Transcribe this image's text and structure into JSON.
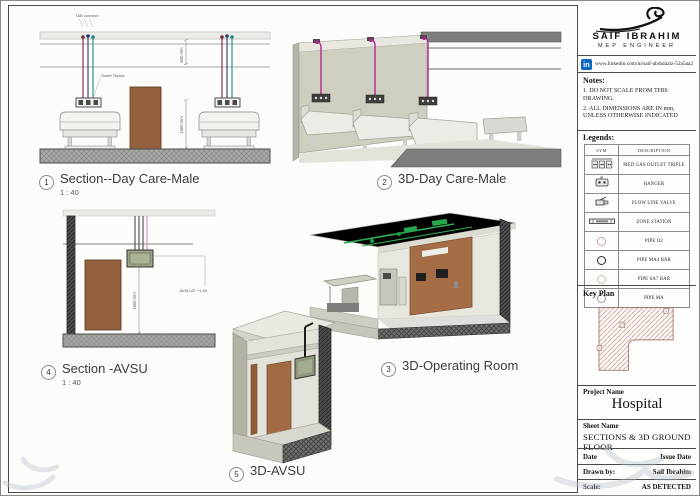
{
  "views": [
    {
      "num": "1",
      "title": "Section--Day Care-Male",
      "scale": "1 : 40"
    },
    {
      "num": "2",
      "title": "3D-Day Care-Male",
      "scale": ""
    },
    {
      "num": "3",
      "title": "3D-Operating Room",
      "scale": ""
    },
    {
      "num": "4",
      "title": "Section -AVSU",
      "scale": "1 : 40"
    },
    {
      "num": "5",
      "title": "3D-AVSU",
      "scale": ""
    }
  ],
  "annotations": {
    "tb_connect": "T&B connect",
    "outlet_triples": "Outlet Triples",
    "dim_ceiling": "600 mm",
    "dim_bed": "1400 mm",
    "dim_avsu": "1600 mm",
    "avsu_level": "AVSU AT +1.60"
  },
  "titleblock": {
    "brand": {
      "name": "SAIF IBRAHIM",
      "tagline": "MEP ENGINEER"
    },
    "linkedin": {
      "label": "in",
      "url": "www.linkedin.com/in/saif-abdulaziz-52a5aa2a5",
      "color": "#0a66c2"
    },
    "notes": {
      "heading": "Notes:",
      "item1": "1. DO NOT SCALE FROM THIS DRAWING.",
      "item2": "2. ALL DIMENSIONS ARE IN mm, UNLESS OTHERWISE INDICATED"
    },
    "legends": {
      "heading": "Legends:",
      "col_sym": "SYM",
      "col_desc": "DESCRIPTION",
      "rows": [
        {
          "label": "MED GAS OUTLET TRIPLE"
        },
        {
          "label": "HANGER"
        },
        {
          "label": "FLOW LINE VALVE"
        },
        {
          "label": "ZONE STATION"
        },
        {
          "label": "PIPE O2",
          "color": "#c9a7a2"
        },
        {
          "label": "PIPE MA4 BAR",
          "color": "#2b2b2b"
        },
        {
          "label": "PIPE SA7 BAR",
          "color": "#b6c7ab"
        },
        {
          "label": "PIPE MA",
          "color": "#9c9c9c"
        }
      ]
    },
    "key_plan": {
      "heading": "Key Plan"
    },
    "project": {
      "label": "Project Name",
      "value": "Hospital"
    },
    "sheet_name": {
      "label": "Sheet Name",
      "value": "SECTIONS & 3D  GROUND FLOOR"
    },
    "date_row": {
      "left": "Date",
      "right": "Issue Date"
    },
    "drawn_row": {
      "left": "Drawn by:",
      "right": "Saif Ibrahim"
    },
    "scale_row": {
      "left": "Scale:",
      "right": "AS DETECTED"
    }
  }
}
